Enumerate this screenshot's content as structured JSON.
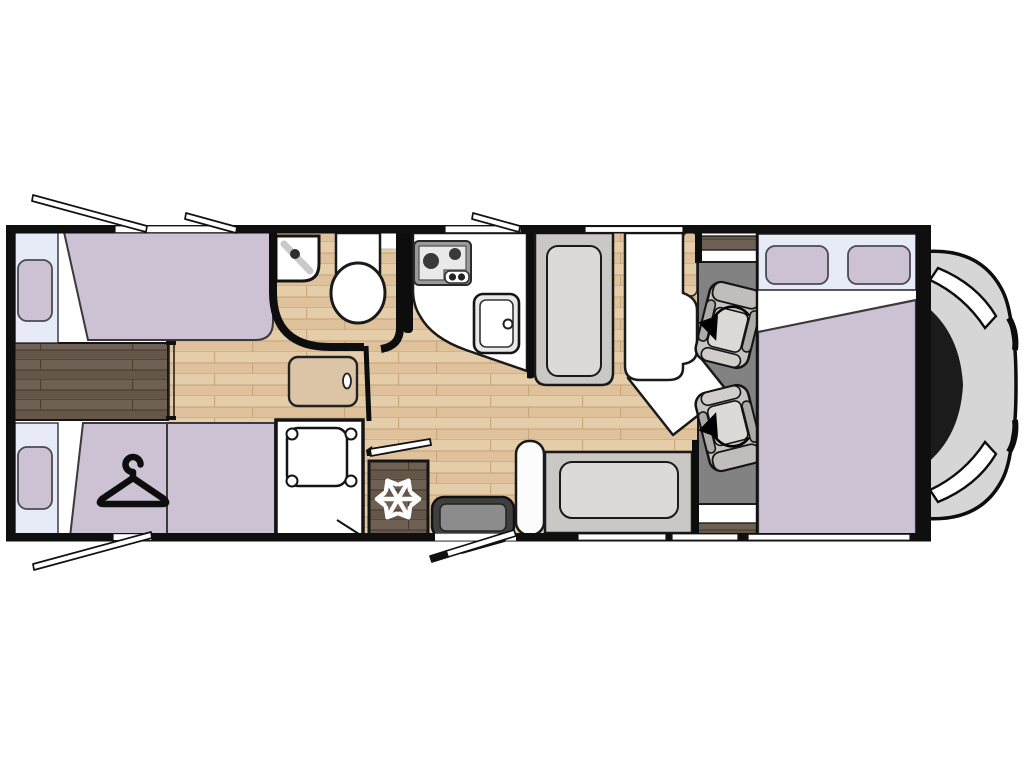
{
  "figure": {
    "type": "motorhome-floorplan",
    "orientation": "side-view-top-down, rear at left, cab at right"
  },
  "colors": {
    "wall": "#0f0f0f",
    "outline": "#141414",
    "white": "#ffffff",
    "lavender": "#cdc1d4",
    "lavenderStroke": "#3a3a3a",
    "windowBlue": "#e7ebf8",
    "woodLight1": "#e6cdaa",
    "woodLight2": "#dfc29c",
    "woodLightLine": "#c9a87e",
    "woodDark1": "#6e6153",
    "woodDark2": "#645749",
    "woodDarkLine": "#4a3f36",
    "carpet": "#828282",
    "benchGray": "#c9c8c5",
    "cushionGray": "#dbdad7",
    "seatGray": "#c6c5c2",
    "seatArm": "#acaba8",
    "seatBack": "#bfbebb",
    "seatFront": "#cfcecb",
    "stepOuter": "#3f3f3f",
    "stepInner": "#8c8c8c",
    "hood": "#d6d6d6",
    "windshield": "#1b1b1b",
    "applianceFrame": "#9a9a9a",
    "appliancePanel": "#e9e9e9",
    "burner": "#3a3a3a",
    "sinkBody": "#e9e9e9",
    "cabinetWood": "#dcc5a6",
    "faucetGray": "#c9c9c9"
  },
  "items": [
    "rear twin bed top",
    "rear twin bed bottom with wardrobe (hanger icon)",
    "rear window with pillow (x2)",
    "dark wood bed platform",
    "corridor step cabinet",
    "bathroom corner washbasin",
    "toilet",
    "shower tray",
    "kitchen counter",
    "two-burner hob",
    "kitchen sink",
    "refrigerator (snowflake icon)",
    "entry step and open entry door",
    "dinette side bench with armrest",
    "dinette forward bench",
    "dinette table with extension leaf",
    "cab swivel seat (x2) with rotation arrow",
    "drop-down bed over cab",
    "overcab window with pillows (x2)",
    "vehicle cab front",
    "open awning windows (x4)"
  ],
  "icons": [
    "hanger-icon",
    "snowflake-icon",
    "swivel-arrow-icon"
  ]
}
